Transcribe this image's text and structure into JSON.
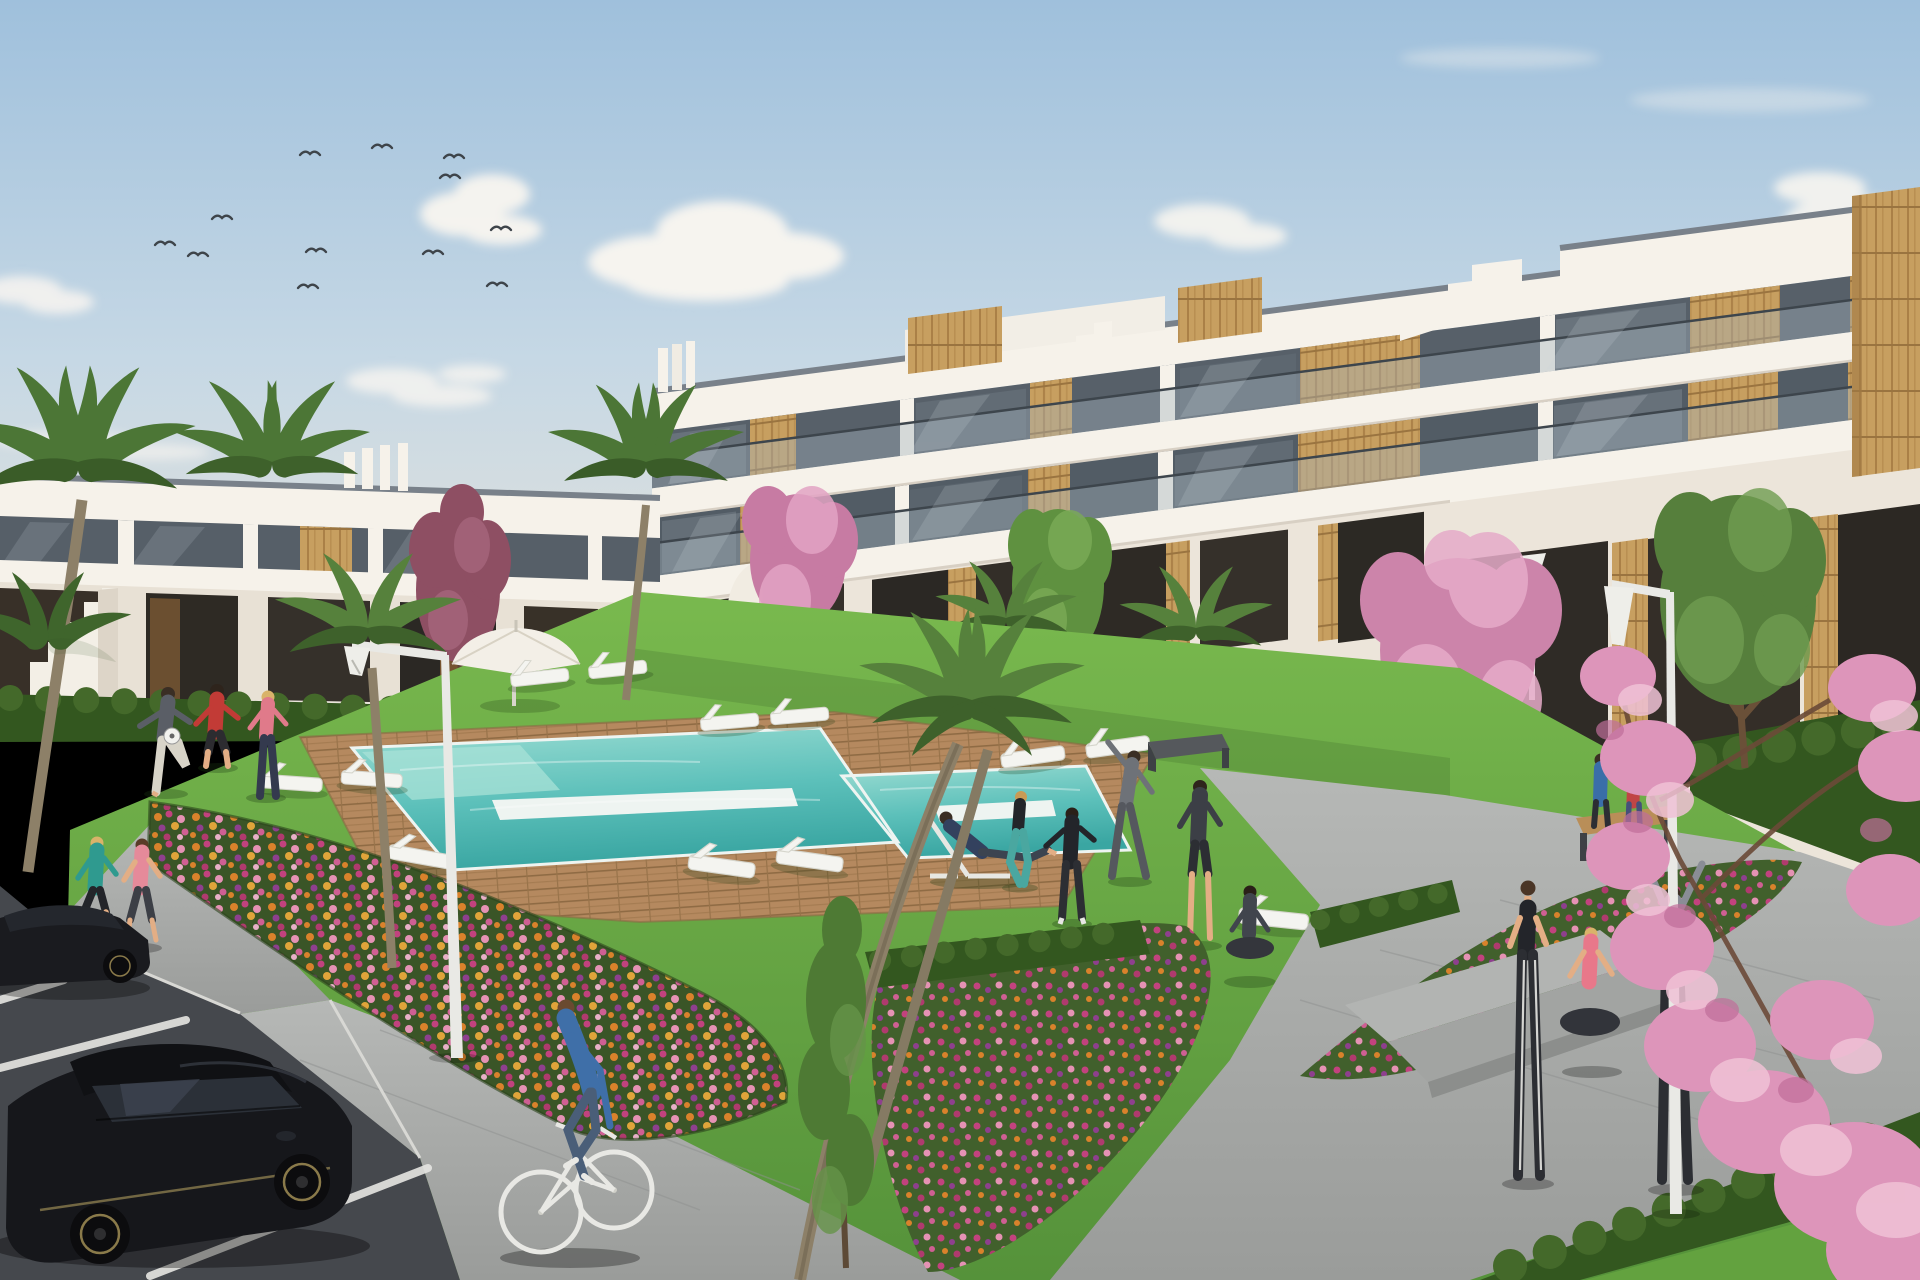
{
  "scene": {
    "kind": "architectural-3d-render",
    "subject": "modern white apartment complex with communal garden, swimming pool and parking",
    "time_of_day": "day",
    "weather": "mostly clear with light clouds"
  },
  "palette": {
    "sky_top": "#9fc0dc",
    "sky_mid": "#c6d8e5",
    "horizon": "#ebe5d9",
    "cloud": "#f8f5f0",
    "bird": "#3e444a",
    "building_white": "#f6f2ea",
    "building_shadow": "#e6dfd3",
    "base_wall": "#ece5da",
    "coping": "#79818a",
    "glass": "#576069",
    "glass_light": "#7d868d",
    "recess_dark": "#2f2b26",
    "balustrade": "#a6b4bf",
    "wood": "#c79f60",
    "wood_dark": "#a07944",
    "plum_tree": "#8e4f63",
    "pink_tree": "#d08fb2",
    "pink_light": "#ecb9d0",
    "palm_green": "#56813c",
    "palm_dark": "#3e612b",
    "trunk": "#8d8068",
    "green_tree": "#5f9140",
    "lawn": "#6fae47",
    "lawn_dark": "#4e8a33",
    "hedge": "#33571f",
    "hedge_light": "#44692a",
    "deck": "#b5895f",
    "deck_dark": "#97744c",
    "pool_far": "#9adcd2",
    "pool_near": "#3aa6a2",
    "pool_slab": "#eef4f1",
    "path": "#a8aaa8",
    "path_light": "#b9bbb9",
    "asphalt": "#45484d",
    "marking": "#e6e6e2",
    "car_body": "#16171b",
    "car_glass": "#2b3038",
    "wheel_ring": "#8a7a4a",
    "skin": "#e3ae85",
    "white": "#f4f4f0",
    "umbrella": "#f3efe7",
    "lamp_white": "#e9e9e5"
  },
  "inventory": {
    "buildings": [
      {
        "name": "left-apartment-block",
        "floors": 2,
        "style": "white render with dark glazing and wood panels"
      },
      {
        "name": "right-apartment-block",
        "floors": 3,
        "style": "white slabs, glass balustrades, vertical wood cladding, roof terraces"
      }
    ],
    "pool": {
      "shape": "rectangular with child pool annex",
      "surround": "timber deck",
      "in_water_benches": 2
    },
    "vegetation": {
      "palms": 8,
      "pink_blossom_trees": 3,
      "plum_tree": 1,
      "green_trees": 3,
      "sapling": 1,
      "flower_beds": 3,
      "hedges": 6
    },
    "furniture": {
      "sun_loungers": 12,
      "parasol": 1,
      "benches": 3,
      "street_lamps": 4
    },
    "people": [
      "ball-player-gray",
      "ball-player-red",
      "ball-player-pink",
      "jogger-teal",
      "jogger-pink",
      "cyclist-blue",
      "man-on-deckchair",
      "crouching-woman-teal",
      "tracksuit-person-black",
      "stretching-man-gray",
      "standing-man-dark",
      "yoga-woman-seated",
      "walking-woman-striped-leggings",
      "sitting-woman-pink",
      "cheering-person-hoodie",
      "bench-couple-blue",
      "bench-couple-red",
      "walkway-woman-purple",
      "walkway-child"
    ],
    "vehicles": {
      "parked_cars": 2,
      "bicycle": 1
    },
    "birds": 12
  }
}
